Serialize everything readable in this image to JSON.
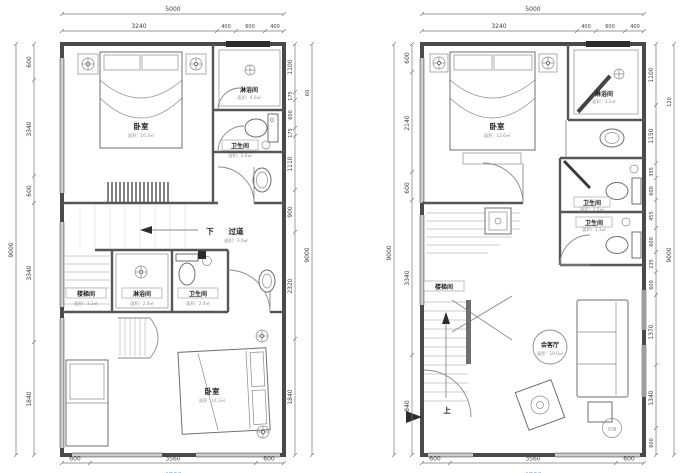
{
  "drawing_type": "residential duplex floor plans (two storeys, Chinese annotations)",
  "colors": {
    "wall": "#4a4a4a",
    "window_band": "#9e9e9e",
    "dimension_text": "#3d3d3d",
    "area_text": "#8f8f8f",
    "cut_bottom_text": "#85aee0"
  },
  "left": {
    "top_overall": "5000",
    "top": [
      "3240",
      "400",
      "600",
      "400"
    ],
    "lcol": [
      "600",
      "3340",
      "600",
      "3340",
      "1840"
    ],
    "lcol_overall": "9000",
    "rcol": [
      "1100",
      "175",
      "600",
      "175",
      "1110",
      "900",
      "2320",
      "1840"
    ],
    "rcol_outer": "60",
    "rcol_overall": "9000",
    "bottom": [
      "600",
      "3560",
      "600"
    ],
    "bottom_overall": "4760",
    "rooms": {
      "bedroom_top": {
        "n": "卧室",
        "a": "面积：16.3㎡"
      },
      "shower_top": {
        "n": "淋浴间",
        "a": "面积：4.0㎡"
      },
      "bath_top": {
        "n": "卫生间",
        "a": "面积：2.6㎡"
      },
      "corridor": {
        "n": "过道",
        "a": "面积：3.0㎡",
        "down": "下"
      },
      "stair": {
        "n": "楼梯间",
        "a": "面积：3.1㎡"
      },
      "shower_mid": {
        "n": "淋浴间",
        "a": "面积：2.8㎡"
      },
      "bath_mid": {
        "n": "卫生间",
        "a": "面积：2.4㎡"
      },
      "bedroom_bottom": {
        "n": "卧室",
        "a": "面积：14.2㎡"
      }
    }
  },
  "right": {
    "top_overall": "5000",
    "top": [
      "3240",
      "400",
      "600",
      "400"
    ],
    "lcol": [
      "600",
      "2140",
      "600",
      "3340",
      "840"
    ],
    "lcol_overall": "9000",
    "rcol": [
      "1100",
      "1150",
      "335",
      "600",
      "455",
      "600",
      "235",
      "600",
      "1370",
      "1340",
      "600"
    ],
    "rcol_outer": "120",
    "rcol_overall": "9000",
    "bottom": [
      "600",
      "3560",
      "600"
    ],
    "bottom_overall": "4760",
    "rooms": {
      "bedroom_top": {
        "n": "卧室",
        "a": "面积：12.6㎡"
      },
      "shower_top": {
        "n": "淋浴间",
        "a": "面积：3.2㎡"
      },
      "bath_1": {
        "n": "卫生间",
        "a": "面积：1.5㎡"
      },
      "bath_2": {
        "n": "卫生间",
        "a": "面积：1.3㎡"
      },
      "stair": {
        "n": "楼梯间"
      },
      "living": {
        "n": "会客厅",
        "a": "面积：19.0㎡"
      },
      "up": "上",
      "ac": "空调"
    }
  }
}
